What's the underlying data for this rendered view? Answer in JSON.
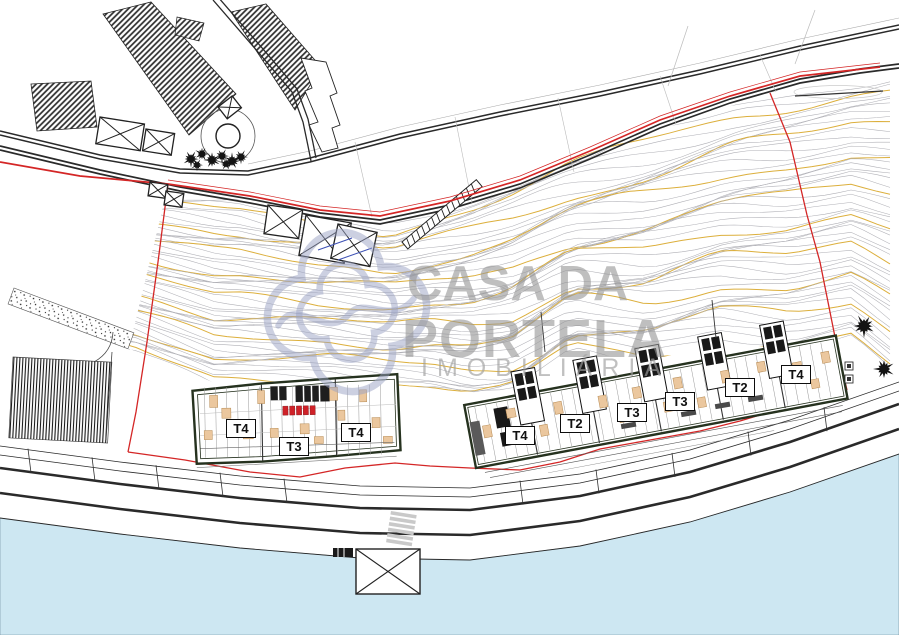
{
  "document": {
    "type": "real-estate site plan drawing",
    "description": "CAD site plan with terrain contour lines, property boundary, two apartment buildings with unit typology labels, waterfront road and river"
  },
  "watermark": {
    "line1": "CASA DA",
    "line2": "PORTELA",
    "line3": "IMOBILIÁRIA",
    "logo": "quatrefoil-clover-outline"
  },
  "buildings": {
    "left": {
      "units": [
        {
          "label": "T4"
        },
        {
          "label": "T3"
        },
        {
          "label": "T4"
        }
      ]
    },
    "right": {
      "units": [
        {
          "label": "T4"
        },
        {
          "label": "T2"
        },
        {
          "label": "T3"
        },
        {
          "label": "T3"
        },
        {
          "label": "T2"
        },
        {
          "label": "T4"
        }
      ]
    }
  },
  "colors": {
    "boundary_red": "#d42626",
    "contour_gray": "#b0b0b6",
    "contour_accent": "#dcaf3c",
    "water_blue": "#cde7f2",
    "line_black": "#2a2a2a",
    "furniture_tan": "#ebc79e",
    "furniture_edge": "#b68a52",
    "accent_red": "#cf2128",
    "logo_blue": "#9aa2c4",
    "watermark_gray": "#949494",
    "tree_black": "#141414",
    "crosswalk_gray": "#c9c9c9"
  }
}
